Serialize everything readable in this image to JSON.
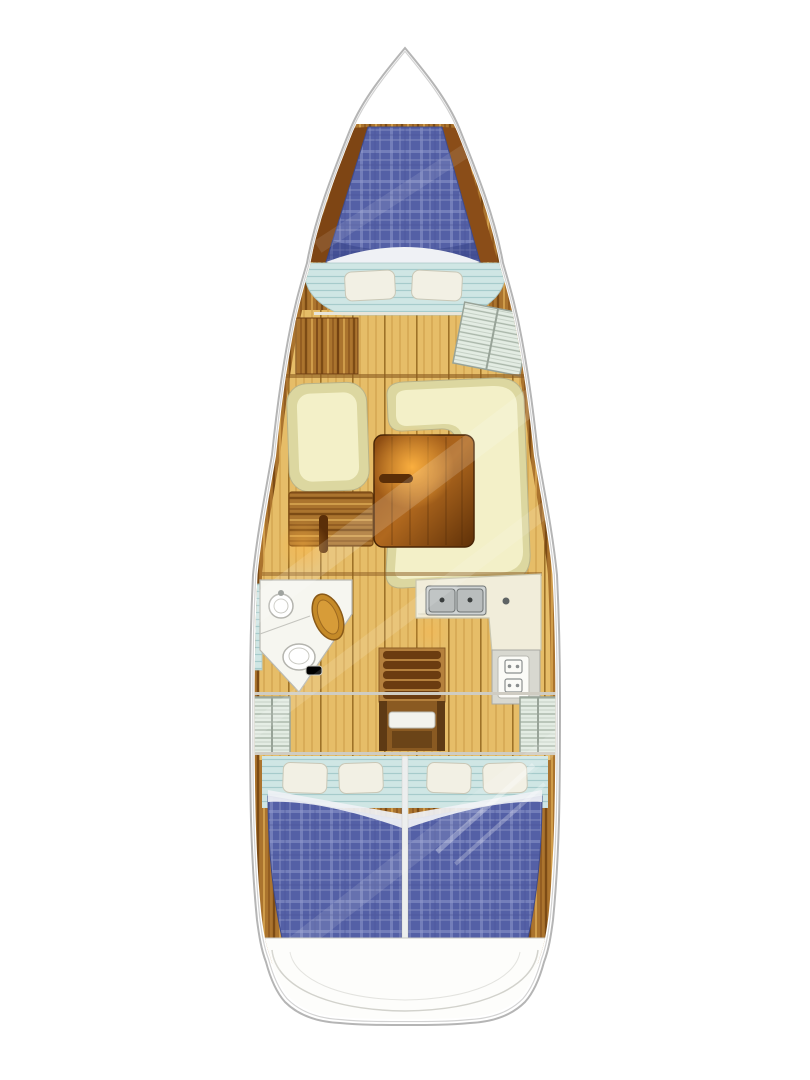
{
  "page": {
    "title": "Sailing yacht interior deck plan, bow up",
    "background": "#ffffff"
  },
  "colors": {
    "hull_fill": "#ffffff",
    "wood_band": "#ab742e",
    "wood_dark": "#7c4b15",
    "wood_light": "#cf9c4a",
    "wood_red": "#8a4d18",
    "wood_red_dark": "#7e4514",
    "floor": "#e6bd68",
    "floor_line": "#c3923c",
    "floor_dark": "#9e7228",
    "mattress": "#5460a6",
    "mattress_grid": "#8790c4",
    "mattress_band": "#9aa2d2",
    "mattress_shadow": "#2e3a7e",
    "sheet": "#eff1f5",
    "pillow": "#f2f0e4",
    "pillow_edge": "#c9c7b6",
    "shelf": "#cfe6e4",
    "shelf_line": "#a6cbcb",
    "settee_edge": "#dcd7a0",
    "settee": "#f3f0c8",
    "table_dark": "#5e3008",
    "table_mid": "#8a4a12",
    "table_light": "#b0681e",
    "glow": "#ffb341",
    "handle": "#5a2e08",
    "head_floor": "#f6f6f0",
    "vanity_wood": "#c58a28",
    "vanity_wood_light": "#d79c38",
    "counter": "#f1edda",
    "sink": "#b9bdbd",
    "sink_frame": "#cfd3d3",
    "drain": "#3a3e3e",
    "stove_frame": "#d8d8d0",
    "stove": "#fbfbf7",
    "burner": "#8b8f8f",
    "locker": "#e3ece3",
    "locker_line": "#a9b6a9",
    "ladder_base": "#b5813d",
    "rung": "#6b3c10",
    "rail": "#5e3a14",
    "well": "#8a5a22",
    "under_step": "#6b4418",
    "step": "#f2f2ec",
    "divider": "#eceeee",
    "stern": "#fdfdfb",
    "stern_line": "#d2d2cc",
    "bulkhead": "#8a5a20",
    "light_line": "#cfccc2",
    "glare": "#ffffff",
    "metal": "#8f938f"
  },
  "vessel": {
    "type": "sailing yacht monohull",
    "view": "interior floor plan, bow at top",
    "rooms": [
      {
        "id": "v-berth",
        "label": "Forward cabin V-berth"
      },
      {
        "id": "forward-shelf",
        "label": "Forward cabin shelf seat"
      },
      {
        "id": "port-cabinet",
        "label": "Port wood cabinet"
      },
      {
        "id": "hatch-locker",
        "label": "Starboard slatted locker"
      },
      {
        "id": "port-settee",
        "label": "Salon port settee"
      },
      {
        "id": "port-table",
        "label": "Port folding table"
      },
      {
        "id": "u-settee",
        "label": "Salon U-shaped settee"
      },
      {
        "id": "salon-table",
        "label": "Salon table"
      },
      {
        "id": "head",
        "label": "Head with toilet, sink and vanity"
      },
      {
        "id": "galley",
        "label": "L-shaped galley with double sink and stove"
      },
      {
        "id": "companionway",
        "label": "Companionway ladder and step"
      },
      {
        "id": "aft-lockers",
        "label": "Aft side lockers"
      },
      {
        "id": "aft-cabin-port",
        "label": "Aft cabin port double berth"
      },
      {
        "id": "aft-cabin-starboard",
        "label": "Aft cabin starboard double berth"
      },
      {
        "id": "stern",
        "label": "Stern transom area"
      }
    ]
  }
}
